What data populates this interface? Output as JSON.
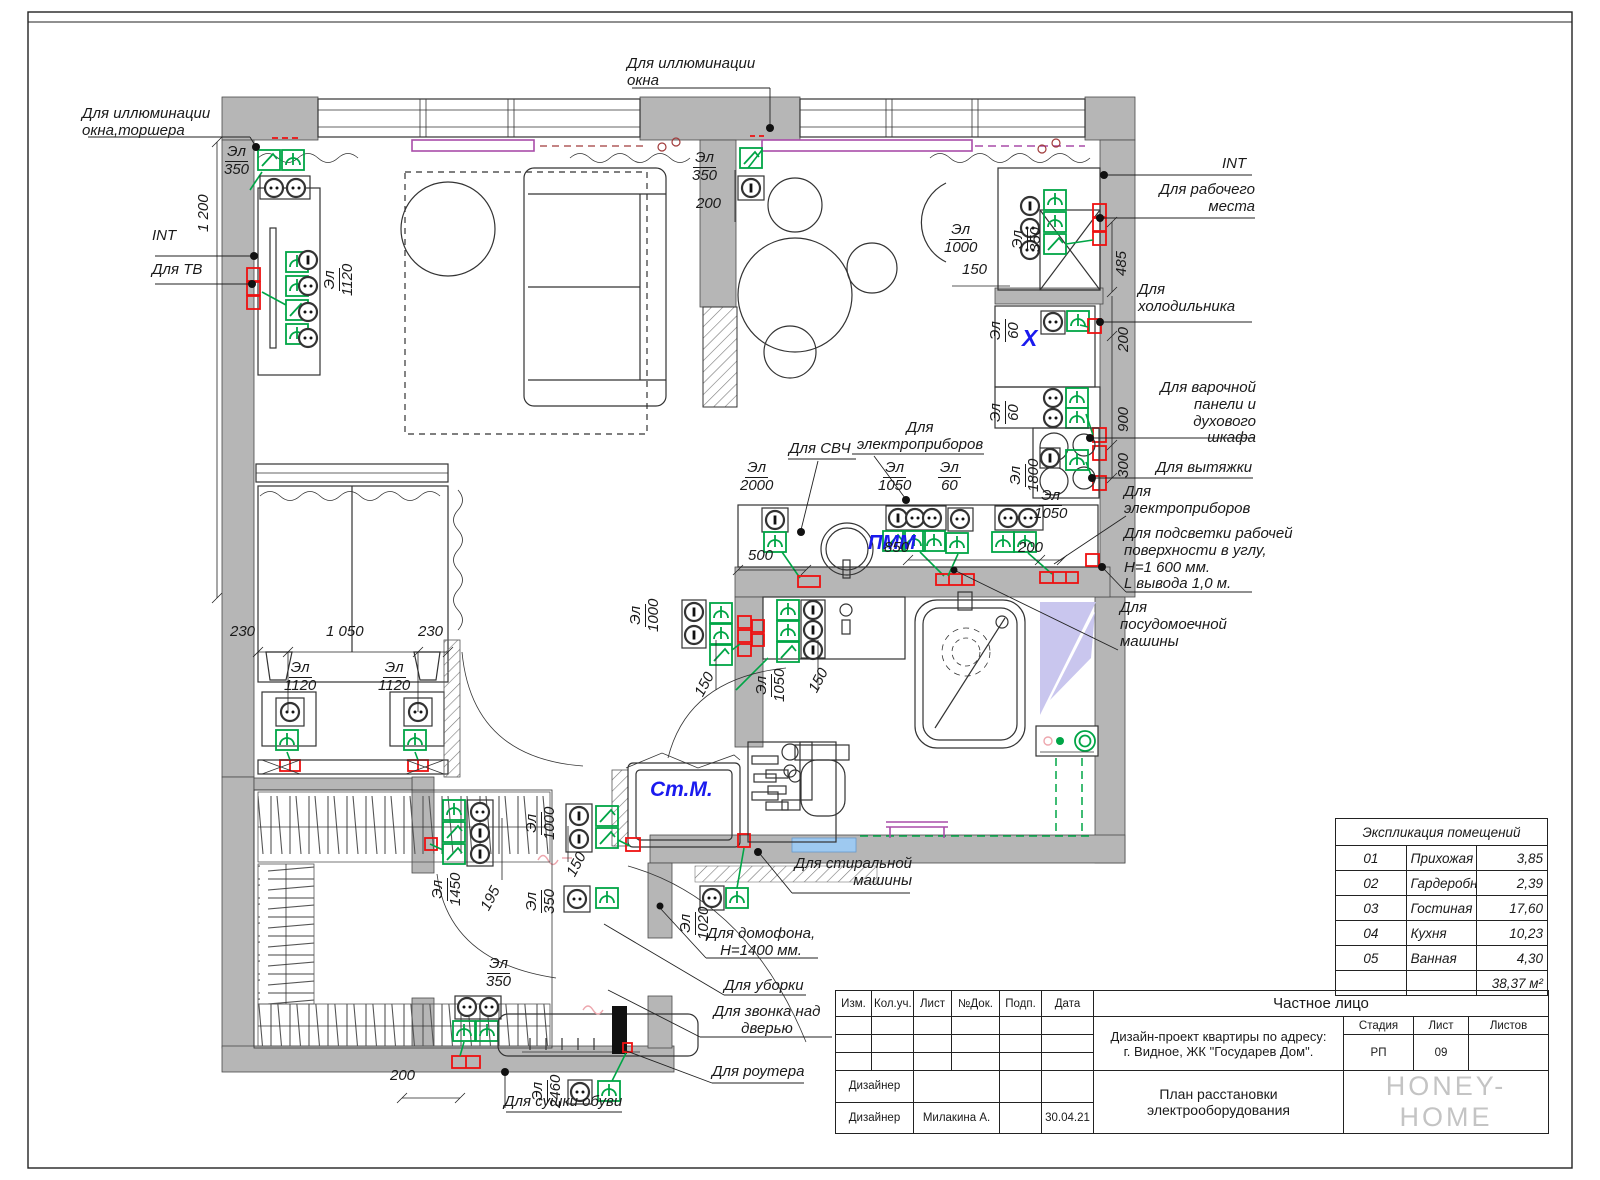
{
  "stamp": {
    "cols": [
      "Изм.",
      "Кол.уч.",
      "Лист",
      "№Док.",
      "Подп.",
      "Дата"
    ],
    "client": "Частное лицо",
    "project": "Дизайн-проект квартиры по адресу:\nг. Видное, ЖК \"Государев Дом\".",
    "stage_label": "Стадия",
    "sheet_label": "Лист",
    "sheets_label": "Листов",
    "stage": "РП",
    "sheet_num": "09",
    "designer_label_1": "Дизайнер",
    "designer_label_2": "Дизайнер",
    "designer_name": "Милакина А.",
    "date": "30.04.21",
    "drawing_title": "План расстановки\nэлектрооборудования",
    "logo": "HONEY-HOME"
  },
  "explication": {
    "title": "Экспликация помещений",
    "rows": [
      {
        "num": "01",
        "name": "Прихожая",
        "area": "3,85"
      },
      {
        "num": "02",
        "name": "Гардеробная",
        "area": "2,39"
      },
      {
        "num": "03",
        "name": "Гостиная",
        "area": "17,60"
      },
      {
        "num": "04",
        "name": "Кухня",
        "area": "10,23"
      },
      {
        "num": "05",
        "name": "Ванная",
        "area": "4,30"
      }
    ],
    "total": "38,37 м²"
  },
  "colors": {
    "accent_green": "#00a546",
    "accent_red": "#ee1111",
    "accent_blue": "#1a1aee",
    "wall_gray": "#b6b6b6",
    "curtain_purple": "#a94ca9"
  },
  "plan": {
    "labels": [
      {
        "id": "lbl-illum-window-floorlamp",
        "text": "Для иллюминации\nокна,торшера",
        "x": 82,
        "y": 106
      },
      {
        "id": "dim-1200",
        "text": "1 200",
        "x": 196,
        "y": 232,
        "rot": -90
      },
      {
        "id": "lbl-int-left",
        "text": "INT",
        "x": 152,
        "y": 228
      },
      {
        "id": "lbl-tv",
        "text": "Для ТВ",
        "x": 152,
        "y": 262
      },
      {
        "id": "mark-el-350-left",
        "t1": "Эл",
        "t2": "350",
        "x": 224,
        "y": 144
      },
      {
        "id": "mark-el-1120-tv",
        "t1": "Эл",
        "t2": "1120",
        "x": 322,
        "y": 296,
        "rot": -90
      },
      {
        "id": "lbl-illum-window-top",
        "text": "Для иллюминации\nокна",
        "x": 627,
        "y": 56
      },
      {
        "id": "mark-el-350-top",
        "t1": "Эл",
        "t2": "350",
        "x": 692,
        "y": 150
      },
      {
        "id": "dim-200-top",
        "text": "200",
        "x": 696,
        "y": 196
      },
      {
        "id": "lbl-int-right",
        "text": "INT",
        "x": 1222,
        "y": 156
      },
      {
        "id": "lbl-workplace",
        "text": "Для рабочего\nместа",
        "x": 1155,
        "y": 182,
        "w": 100,
        "align": "right"
      },
      {
        "id": "mark-el-350-desk",
        "t1": "Эл",
        "t2": "350",
        "x": 1010,
        "y": 252,
        "rot": -90
      },
      {
        "id": "mark-el-1000-desk",
        "t1": "Эл",
        "t2": "1000",
        "x": 944,
        "y": 222
      },
      {
        "id": "dim-150-desk",
        "text": "150",
        "x": 962,
        "y": 262
      },
      {
        "id": "dim-485",
        "text": "485",
        "x": 1114,
        "y": 276,
        "rot": -90
      },
      {
        "id": "lbl-fridge",
        "text": "Для\nхолодильника",
        "x": 1138,
        "y": 282
      },
      {
        "id": "mark-el-60-fridge",
        "t1": "Эл",
        "t2": "60",
        "x": 988,
        "y": 342,
        "rot": -90
      },
      {
        "id": "lbl-x-fridge",
        "text": "X",
        "x": 1022,
        "y": 326,
        "color": "#1a1aee",
        "size": 23
      },
      {
        "id": "dim-200-right",
        "text": "200",
        "x": 1116,
        "y": 352,
        "rot": -90
      },
      {
        "id": "dim-900",
        "text": "900",
        "x": 1116,
        "y": 432,
        "rot": -90
      },
      {
        "id": "lbl-cooktop-oven",
        "text": "Для варочной\nпанели и\nдухового шкафа",
        "x": 1148,
        "y": 380,
        "w": 108,
        "align": "right"
      },
      {
        "id": "mark-el-60-cooktop",
        "t1": "Эл",
        "t2": "60",
        "x": 988,
        "y": 424,
        "rot": -90
      },
      {
        "id": "mark-el-1800",
        "t1": "Эл",
        "t2": "1800",
        "x": 1008,
        "y": 492,
        "rot": -90
      },
      {
        "id": "dim-300",
        "text": "300",
        "x": 1116,
        "y": 478,
        "rot": -90
      },
      {
        "id": "lbl-hood",
        "text": "Для вытяжки",
        "x": 1156,
        "y": 460
      },
      {
        "id": "lbl-appliances-right",
        "text": "Для\nэлектроприборов",
        "x": 1124,
        "y": 484
      },
      {
        "id": "lbl-worktop-light",
        "text": "Для подсветки рабочей\nповерхности в углу,\nН=1 600 мм.\nL вывода 1,0 м.",
        "x": 1124,
        "y": 526
      },
      {
        "id": "lbl-dishwasher",
        "text": "Для\nпосудомоечной\nмашины",
        "x": 1120,
        "y": 600
      },
      {
        "id": "lbl-microwave",
        "text": "Для СВЧ",
        "x": 789,
        "y": 441
      },
      {
        "id": "lbl-appliances-kitchen",
        "text": "Для\nэлектроприборов",
        "x": 852,
        "y": 420,
        "w": 136,
        "align": "center"
      },
      {
        "id": "mark-el-2000",
        "t1": "Эл",
        "t2": "2000",
        "x": 740,
        "y": 460
      },
      {
        "id": "mark-el-1050-kitchen1",
        "t1": "Эл",
        "t2": "1050",
        "x": 878,
        "y": 460
      },
      {
        "id": "mark-el-60-kitchen",
        "t1": "Эл",
        "t2": "60",
        "x": 938,
        "y": 460
      },
      {
        "id": "mark-el-1050-kitchen2",
        "t1": "Эл",
        "t2": "1050",
        "x": 1034,
        "y": 488
      },
      {
        "id": "lbl-pmm",
        "text": "ПММ",
        "x": 868,
        "y": 532,
        "color": "#1a1aee",
        "size": 20
      },
      {
        "id": "dim-500",
        "text": "500",
        "x": 748,
        "y": 548
      },
      {
        "id": "dim-850",
        "text": "850",
        "x": 884,
        "y": 540
      },
      {
        "id": "dim-200-kitchen",
        "text": "200",
        "x": 1018,
        "y": 540
      },
      {
        "id": "mark-el-1000-bath",
        "t1": "Эл",
        "t2": "1000",
        "x": 628,
        "y": 632,
        "rot": -90
      },
      {
        "id": "dim-150-bathdoor",
        "text": "150",
        "x": 692,
        "y": 692,
        "rot": -62
      },
      {
        "id": "mark-el-1050-bath",
        "t1": "Эл",
        "t2": "1050",
        "x": 754,
        "y": 702,
        "rot": -90
      },
      {
        "id": "dim-150-bath2",
        "text": "150",
        "x": 806,
        "y": 688,
        "rot": -62
      },
      {
        "id": "dim-230-left",
        "text": "230",
        "x": 230,
        "y": 624
      },
      {
        "id": "dim-1050-bed",
        "text": "1 050",
        "x": 326,
        "y": 624
      },
      {
        "id": "dim-230-right",
        "text": "230",
        "x": 418,
        "y": 624
      },
      {
        "id": "mark-el-1120-bed1",
        "t1": "Эл",
        "t2": "1120",
        "x": 284,
        "y": 660
      },
      {
        "id": "mark-el-1120-bed2",
        "t1": "Эл",
        "t2": "1120",
        "x": 378,
        "y": 660
      },
      {
        "id": "mark-el-1450",
        "t1": "Эл",
        "t2": "1450",
        "x": 430,
        "y": 906,
        "rot": -90
      },
      {
        "id": "dim-195",
        "text": "195",
        "x": 478,
        "y": 906,
        "rot": -62
      },
      {
        "id": "mark-el-1000-hall",
        "t1": "Эл",
        "t2": "1000",
        "x": 524,
        "y": 840,
        "rot": -90
      },
      {
        "id": "dim-150-hall",
        "text": "150",
        "x": 564,
        "y": 872,
        "rot": -62
      },
      {
        "id": "mark-el-350-hall",
        "t1": "Эл",
        "t2": "350",
        "x": 524,
        "y": 914,
        "rot": -90
      },
      {
        "id": "mark-el-1020",
        "t1": "Эл",
        "t2": "1020",
        "x": 678,
        "y": 940,
        "rot": -90
      },
      {
        "id": "lbl-washing-machine-text",
        "text": "Ст.М.",
        "x": 650,
        "y": 778,
        "color": "#1a1aee",
        "size": 21
      },
      {
        "id": "lbl-washer",
        "text": "Для стиральной\nмашины",
        "x": 790,
        "y": 856,
        "w": 122,
        "align": "right"
      },
      {
        "id": "lbl-intercom",
        "text": "Для домофона,\nН=1400 мм.",
        "x": 702,
        "y": 926,
        "w": 118,
        "align": "center"
      },
      {
        "id": "lbl-cleaning",
        "text": "Для уборки",
        "x": 724,
        "y": 978
      },
      {
        "id": "lbl-doorbell",
        "text": "Для звонка над\nдверью",
        "x": 700,
        "y": 1004,
        "w": 134,
        "align": "center"
      },
      {
        "id": "lbl-router",
        "text": "Для роутера",
        "x": 712,
        "y": 1064
      },
      {
        "id": "mark-el-350-entry",
        "t1": "Эл",
        "t2": "350",
        "x": 486,
        "y": 956
      },
      {
        "id": "dim-200-entry",
        "text": "200",
        "x": 390,
        "y": 1068
      },
      {
        "id": "mark-el-2460",
        "t1": "Эл",
        "t2": "2460",
        "x": 530,
        "y": 1108,
        "rot": -90
      },
      {
        "id": "lbl-shoe-dryer",
        "text": "Для сушки обуви",
        "x": 504,
        "y": 1094
      }
    ]
  }
}
